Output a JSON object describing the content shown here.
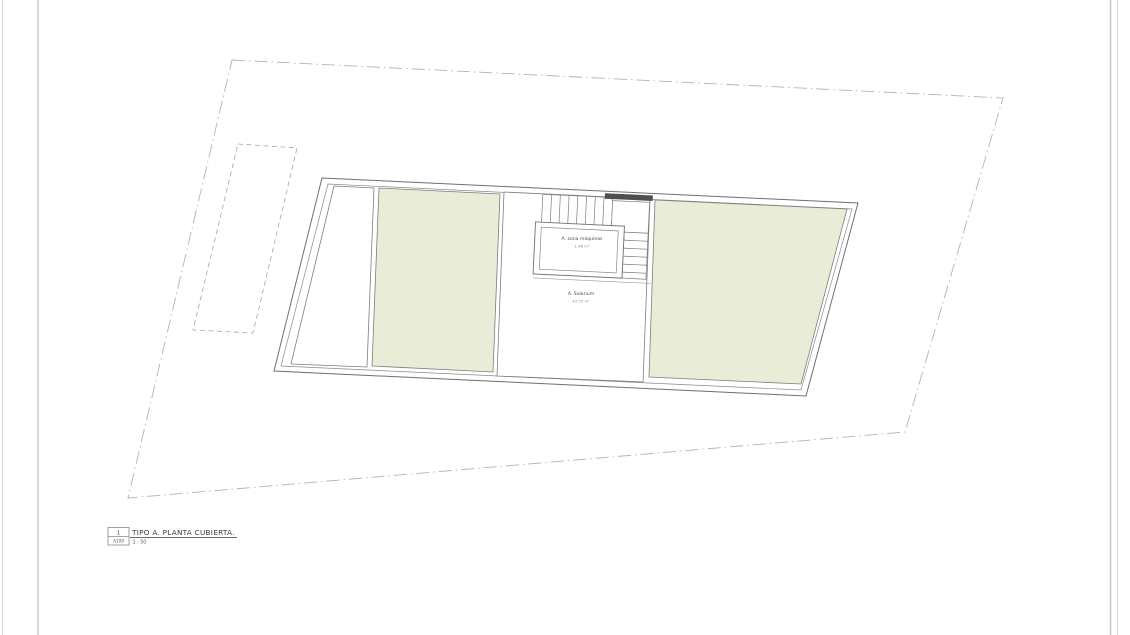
{
  "sheet": {
    "background": "#ffffff",
    "margin_line_color": "#c9c9c9"
  },
  "plan": {
    "colors": {
      "roof_fill": "#e9edd7",
      "outline": "#6f6f6f",
      "inner_line": "#8a8a8a",
      "boundary_dash": "#b3b3b3",
      "stair_wall_fill": "#4f4f4f"
    },
    "rooms": {
      "machine_room": {
        "label": "A. zona máquinas",
        "area": "1.46 m²"
      },
      "solarium": {
        "label": "A. Solarium",
        "area": "43.55 m²"
      }
    }
  },
  "title_block": {
    "view_number": "1",
    "sheet_ref": "A109",
    "title": "TIPO A. PLANTA CUBIERTA.",
    "scale": "1 : 50"
  }
}
